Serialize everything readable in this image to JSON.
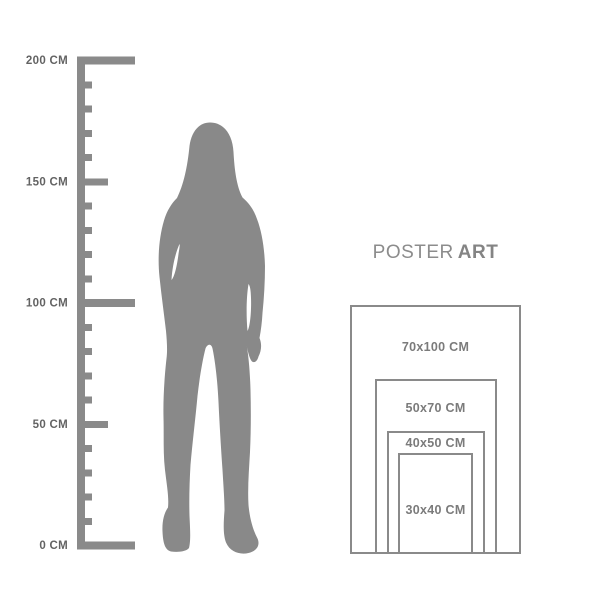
{
  "title": {
    "regular": "POSTER",
    "bold": "ART"
  },
  "ruler": {
    "labels": [
      "200 CM",
      "150 CM",
      "100 CM",
      "50 CM",
      "0 CM"
    ]
  },
  "posters": [
    {
      "label": "70x100 CM"
    },
    {
      "label": "50x70 CM"
    },
    {
      "label": "40x50 CM"
    },
    {
      "label": "30x40 CM"
    }
  ],
  "silhouette": {
    "name": "standing-woman-silhouette"
  },
  "colors": {
    "ruler": "#8a8a8a",
    "ruler_label": "#636363",
    "silhouette": "#898989",
    "poster_border": "#8a8a8a",
    "poster_label": "#7b7b7b",
    "title": "#8c8c8c",
    "background": "#ffffff"
  }
}
